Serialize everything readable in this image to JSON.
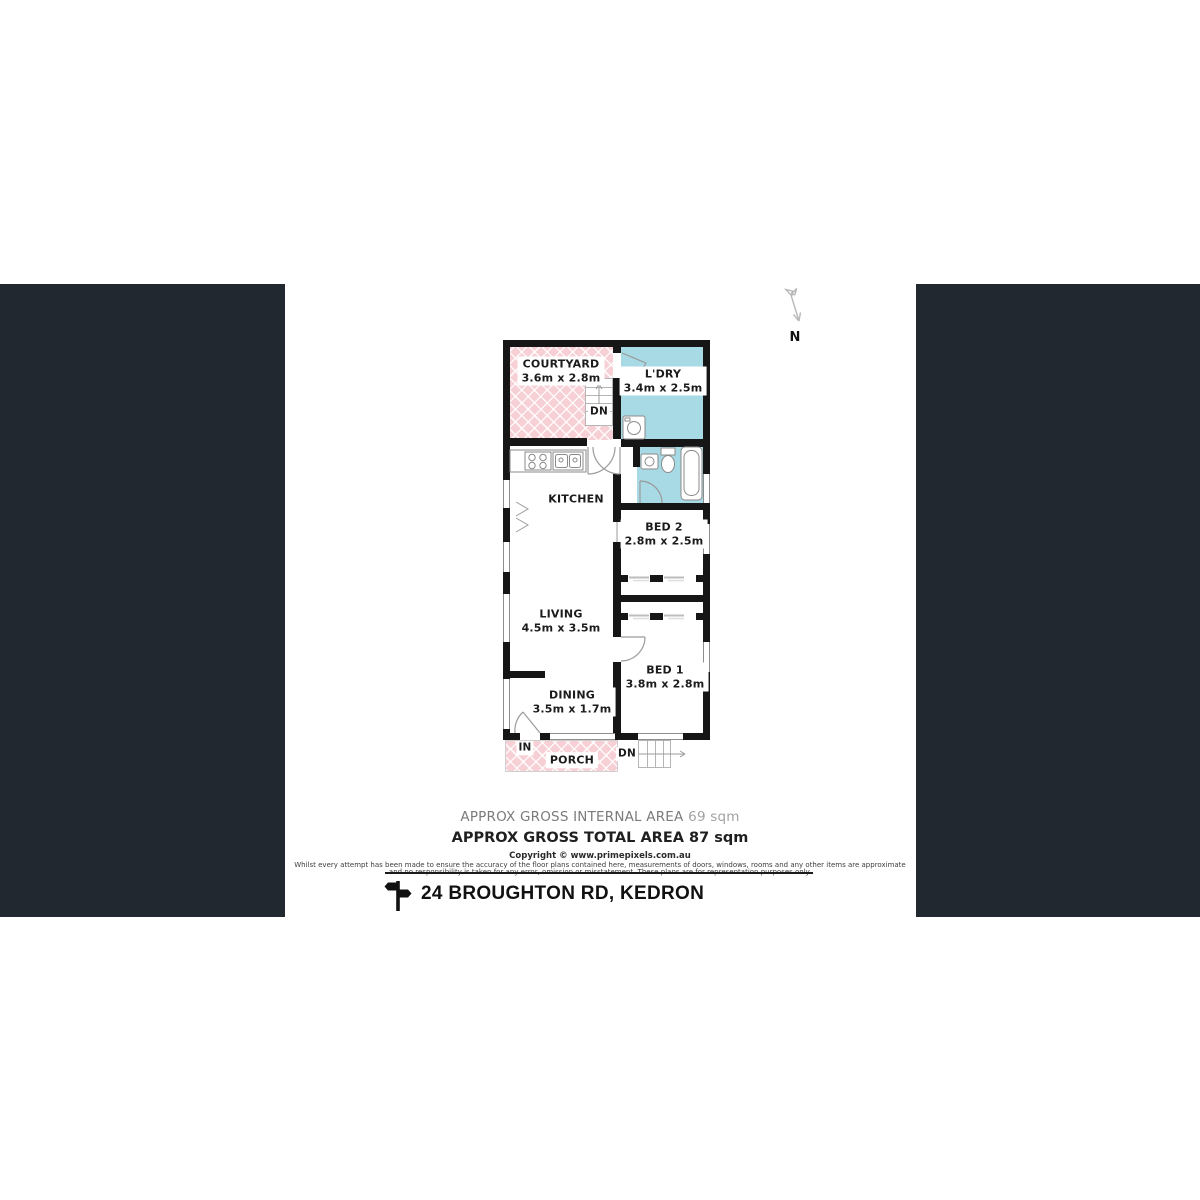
{
  "page": {
    "background": "#ffffff",
    "pillarbox_color": "#212830",
    "wall_color": "#161616",
    "outdoor_pink": "#f6d0d5",
    "wet_area_blue": "#a7dae4"
  },
  "compass": {
    "north_label": "N"
  },
  "floorplan": {
    "rooms": {
      "courtyard": {
        "name": "COURTYARD",
        "dims": "3.6m x 2.8m"
      },
      "ldry": {
        "name": "L'DRY",
        "dims": "3.4m x 2.5m"
      },
      "kitchen": {
        "name": "KITCHEN"
      },
      "bed2": {
        "name": "BED 2",
        "dims": "2.8m x 2.5m"
      },
      "living": {
        "name": "LIVING",
        "dims": "4.5m x 3.5m"
      },
      "bed1": {
        "name": "BED 1",
        "dims": "3.8m x 2.8m"
      },
      "dining": {
        "name": "DINING",
        "dims": "3.5m x 1.7m"
      },
      "porch": {
        "name": "PORCH"
      }
    },
    "markers": {
      "down_top": "DN",
      "down_bottom": "DN",
      "entry": "IN"
    }
  },
  "summary": {
    "internal_label": "APPROX GROSS INTERNAL AREA",
    "internal_value": "69 sqm",
    "total_label": "APPROX GROSS TOTAL AREA",
    "total_value": "87 sqm"
  },
  "legal": {
    "copyright": "Copyright © www.primepixels.com.au",
    "disclaimer_line1": "Whilst every attempt has been made to ensure the accuracy of the floor plans contained here, measurements of doors, windows, rooms and any other items are approximate",
    "disclaimer_line2": "and no responsibility is taken for any error, omission or misstatement. These plans are for representation purposes only."
  },
  "footer": {
    "address": "24 BROUGHTON RD, KEDRON"
  }
}
